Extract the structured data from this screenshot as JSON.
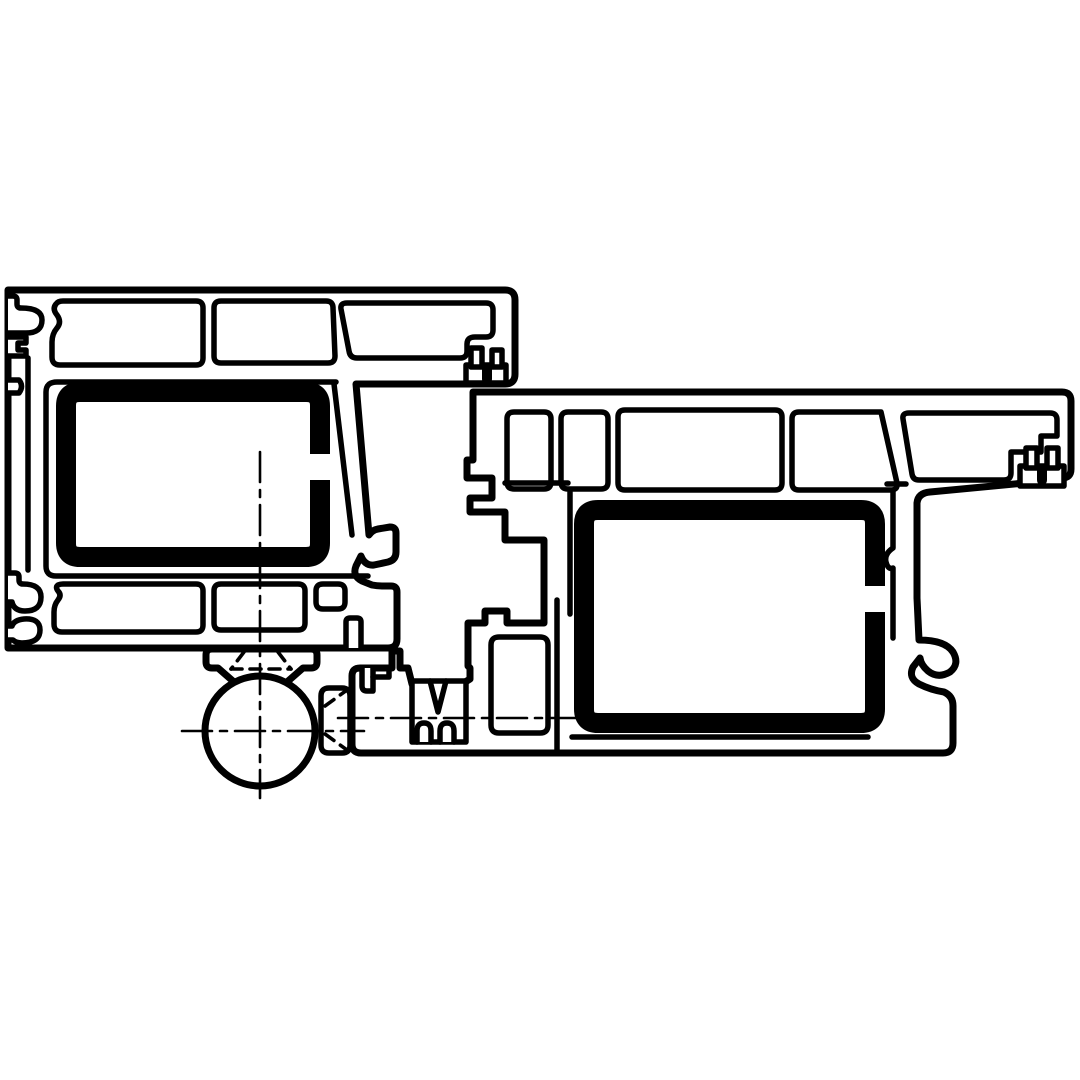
{
  "meta": {
    "description": "Technical cross-section drawing of two extruded door/window profiles (frame and leaf) with hollow chambers, steel reinforcement tubes, gasket grooves, a threshold connector and a barrel hinge",
    "canvas": {
      "width": 1080,
      "height": 1080,
      "background": "#ffffff"
    }
  },
  "palette": {
    "ink": "#000000",
    "paper": "#ffffff"
  },
  "line_weights": {
    "outer": 7,
    "inner": 5.5,
    "steel": 20,
    "centerline": 2.6,
    "hidden": 3.6
  },
  "dash_patterns": {
    "centerline": "30 8 7 8",
    "hidden": "11 8"
  },
  "drawing": {
    "shapes": [
      {
        "id": "frame-profile-body",
        "kind": "path",
        "d": "M 8 290 L 505 290 Q 515 290 515 300 L 515 374 Q 515 384 505 384 L 356 384 L 369 535 Q 372 530 378 529 L 390 527 Q 396 527 396 533 L 396 552 Q 396 560 388 562 L 374 565 Q 365 566 361 556 L 356 566 Q 352 576 362 581 L 372 585 Q 377 586 383 586 L 391 586 Q 397 586 397 592 L 397 639 Q 397 648 388 648 L 8 648 Z",
        "fill": "paper",
        "stroke": "ink",
        "w": "outer"
      },
      {
        "id": "frame-gasket-groove-top",
        "kind": "path",
        "d": "M 8 296 L 13 296 Q 17 296 17 300 L 17 304 Q 17 308 21 308 Q 42 308 42 320 Q 42 333 26 333 L 8 333",
        "fill": "paper",
        "stroke": "ink",
        "w": "inner"
      },
      {
        "id": "frame-gasket-groove-mid",
        "kind": "path",
        "d": "M 8 337 L 26 337 L 26 343 L 18 343 L 18 350 L 26 350 L 26 356 L 8 356",
        "fill": "paper",
        "stroke": "ink",
        "w": "inner"
      },
      {
        "id": "frame-gasket-groove-small",
        "kind": "path",
        "d": "M 8 380 L 19 380 Q 24 386 19 393 L 8 393",
        "fill": "paper",
        "stroke": "ink",
        "w": "inner"
      },
      {
        "id": "frame-gasket-pocket-lower-1",
        "kind": "path",
        "d": "M 8 573 L 15 573 Q 19 573 19 577 L 19 580 Q 19 584 23 584 Q 41 584 41 597 Q 41 611 25 611 Q 14 611 12 602 L 8 602",
        "fill": "paper",
        "stroke": "ink",
        "w": "inner"
      },
      {
        "id": "frame-gasket-pocket-lower-2",
        "kind": "path",
        "d": "M 8 640 L 13 640 Q 16 643 22 643 Q 40 643 40 630 Q 40 618 24 619 Q 14 620 12 626 L 8 626",
        "fill": "paper",
        "stroke": "ink",
        "w": "inner"
      },
      {
        "id": "frame-wall-vertical",
        "kind": "path",
        "d": "M 28 358 L 28 570",
        "fill": "none",
        "stroke": "ink",
        "w": "inner"
      },
      {
        "id": "frame-chamber-top-1",
        "kind": "path",
        "d": "M 63 301 L 196 301 Q 203 301 203 308 L 203 358 Q 203 365 196 365 L 60 365 Q 52 365 52 357 L 52 342 Q 52 334 57 328 Q 62 322 57 315 Q 52 309 56 304 Q 58 301 63 301 Z",
        "fill": "paper",
        "stroke": "ink",
        "w": "inner"
      },
      {
        "id": "frame-chamber-top-2",
        "kind": "path",
        "d": "M 221 301 L 326 301 Q 333 301 333 308 L 335 356 Q 335 363 328 363 L 221 363 Q 214 363 214 356 L 214 308 Q 214 301 221 301 Z",
        "fill": "paper",
        "stroke": "ink",
        "w": "inner"
      },
      {
        "id": "frame-chamber-top-3",
        "kind": "path",
        "d": "M 347 303 L 486 303 Q 493 303 493 310 L 493 330 Q 493 337 486 337 L 475 337 Q 467 337 467 344 L 467 351 Q 467 358 460 358 L 357 358 Q 350 358 349 351 L 341 309 Q 340 303 347 303 Z",
        "fill": "paper",
        "stroke": "ink",
        "w": "inner"
      },
      {
        "id": "frame-steel-chamber-wall",
        "kind": "path",
        "d": "M 336 382 L 57 382 Q 46 382 46 392 L 46 566 Q 46 576 56 576 L 368 576",
        "fill": "none",
        "stroke": "ink",
        "w": "inner"
      },
      {
        "id": "frame-inner-diagonal-wall",
        "kind": "path",
        "d": "M 334 384 L 352 535",
        "fill": "none",
        "stroke": "ink",
        "w": "inner"
      },
      {
        "id": "frame-chamber-bottom-1",
        "kind": "path",
        "d": "M 63 584 L 196 584 Q 203 584 203 591 L 203 625 Q 203 632 196 632 L 62 632 Q 54 632 54 624 L 54 612 Q 54 605 58 600 Q 62 595 58 591 Q 55 587 58 585 Q 60 584 63 584 Z",
        "fill": "paper",
        "stroke": "ink",
        "w": "inner"
      },
      {
        "id": "frame-chamber-bottom-2",
        "kind": "path",
        "d": "M 221 584 L 298 584 Q 305 584 305 591 L 305 623 Q 305 630 298 630 L 221 630 Q 214 630 214 623 L 214 591 Q 214 584 221 584 Z",
        "fill": "paper",
        "stroke": "ink",
        "w": "inner"
      },
      {
        "id": "frame-chamber-bottom-3",
        "kind": "path",
        "d": "M 323 584 L 338 584 Q 345 584 345 591 L 345 602 Q 345 609 338 609 L 323 609 Q 316 609 316 602 L 316 591 Q 316 584 323 584 Z",
        "fill": "paper",
        "stroke": "ink",
        "w": "inner"
      },
      {
        "id": "frame-bottom-slot",
        "kind": "path",
        "d": "M 346 648 L 346 622 Q 346 618 350 618 L 357 618 Q 361 618 361 622 L 361 648",
        "fill": "paper",
        "stroke": "ink",
        "w": "inner"
      },
      {
        "id": "frame-hardware-groove-bar",
        "kind": "path",
        "d": "M 466 365 L 506 365 L 506 383 L 466 383 Z",
        "fill": "paper",
        "stroke": "ink",
        "w": "inner"
      },
      {
        "id": "frame-hardware-groove-lobe-1",
        "kind": "path",
        "d": "M 471 348 L 482 348 L 482 367 L 471 367 Z",
        "fill": "paper",
        "stroke": "ink",
        "w": "inner"
      },
      {
        "id": "frame-hardware-groove-lobe-2",
        "kind": "path",
        "d": "M 492 350 L 502 350 L 502 367 L 492 367 Z",
        "fill": "paper",
        "stroke": "ink",
        "w": "inner"
      },
      {
        "id": "frame-hardware-groove-tongue",
        "kind": "path",
        "d": "M 482 365 L 492 365 L 492 379 Q 492 384 487 384 Q 482 384 482 379 Z",
        "fill": "ink",
        "stroke": "none",
        "w": "inner"
      },
      {
        "id": "leaf-profile-body",
        "kind": "path",
        "d": "M 473 392 L 1062 392 Q 1071 392 1071 401 L 1071 469 Q 1071 478 1062 478 L 1056 480 L 930 492 Q 918 493 917 503 L 917 598 L 919 640 Q 945 640 953 652 Q 960 664 950 672 Q 938 679 928 671 Q 921 665 920 658 L 913 667 Q 908 678 919 684 Q 931 690 944 692 Q 953 696 953 706 L 953 743 Q 953 753 943 753 L 361 753 Q 352 753 352 744 L 352 676 Q 352 668 360 668 L 392 668 L 392 651 L 400 651 L 400 668 L 408 668 L 412 684 L 462 684 L 470 679 L 470 668 L 468 666 L 468 623 L 485 623 L 485 611 L 507 611 L 507 623 L 544 623 L 544 540 L 505 540 L 505 512 L 470 512 L 470 498 L 492 498 L 492 478 L 467 478 L 467 460 L 473 460 Z",
        "fill": "paper",
        "stroke": "ink",
        "w": "outer"
      },
      {
        "id": "leaf-chamber-1",
        "kind": "path",
        "d": "M 514 412 L 544 412 Q 551 412 551 419 L 551 482 Q 551 489 544 489 L 514 489 Q 507 489 507 482 L 507 419 Q 507 412 514 412 Z",
        "fill": "paper",
        "stroke": "ink",
        "w": "inner"
      },
      {
        "id": "leaf-chamber-2",
        "kind": "path",
        "d": "M 568 412 L 601 412 Q 608 412 608 419 L 608 482 Q 608 489 601 489 L 568 489 Q 561 489 561 482 L 561 419 Q 561 412 568 412 Z",
        "fill": "paper",
        "stroke": "ink",
        "w": "inner"
      },
      {
        "id": "leaf-chamber-3",
        "kind": "path",
        "d": "M 625 410 L 775 410 Q 782 410 782 417 L 782 483 Q 782 490 775 490 L 625 490 Q 618 490 618 483 L 618 417 Q 618 410 625 410 Z",
        "fill": "paper",
        "stroke": "ink",
        "w": "inner"
      },
      {
        "id": "leaf-chamber-4",
        "kind": "path",
        "d": "M 799 412 L 881 412 L 897 483 Q 898 490 891 490 L 799 490 Q 792 490 792 483 L 792 419 Q 792 412 799 412 Z",
        "fill": "paper",
        "stroke": "ink",
        "w": "inner"
      },
      {
        "id": "leaf-chamber-5",
        "kind": "path",
        "d": "M 912 474 L 903 419 Q 902 413 909 413 L 1050 413 Q 1057 413 1057 420 L 1057 436 L 1041 436 L 1041 452 L 1011 452 L 1011 473 Q 1011 480 1004 480 L 919 480 Q 913 480 912 474 Z",
        "fill": "paper",
        "stroke": "ink",
        "w": "inner"
      },
      {
        "id": "leaf-steel-chamber-wall-left",
        "kind": "path",
        "d": "M 570 492 L 570 614",
        "fill": "none",
        "stroke": "ink",
        "w": "inner"
      },
      {
        "id": "leaf-steel-chamber-wall-right",
        "kind": "path",
        "d": "M 893 490 L 893 548 Q 884 554 886 562 Q 888 570 893 568 L 893 638",
        "fill": "none",
        "stroke": "ink",
        "w": "inner"
      },
      {
        "id": "leaf-underchamber-line-left",
        "kind": "path",
        "d": "M 505 483 L 568 483",
        "fill": "none",
        "stroke": "ink",
        "w": "inner"
      },
      {
        "id": "leaf-underchamber-line-right",
        "kind": "path",
        "d": "M 887 484 L 906 484",
        "fill": "none",
        "stroke": "ink",
        "w": "inner"
      },
      {
        "id": "leaf-bottom-inner-line",
        "kind": "path",
        "d": "M 572 737 L 868 737",
        "fill": "none",
        "stroke": "ink",
        "w": "inner"
      },
      {
        "id": "leaf-foot-wall",
        "kind": "path",
        "d": "M 557 600 L 557 750",
        "fill": "none",
        "stroke": "ink",
        "w": "inner"
      },
      {
        "id": "leaf-foot-chamber",
        "kind": "path",
        "d": "M 499 637 L 540 637 Q 548 637 548 645 L 548 725 Q 548 733 540 733 L 499 733 Q 491 733 491 725 L 491 645 Q 491 637 499 637 Z",
        "fill": "paper",
        "stroke": "ink",
        "w": "inner"
      },
      {
        "id": "leaf-hardware-groove-bar",
        "kind": "path",
        "d": "M 1020 466 L 1064 466 L 1064 486 L 1020 486 Z",
        "fill": "paper",
        "stroke": "ink",
        "w": "inner"
      },
      {
        "id": "leaf-hardware-groove-lobe-1",
        "kind": "path",
        "d": "M 1026 448 L 1037 448 L 1037 468 L 1026 468 Z",
        "fill": "paper",
        "stroke": "ink",
        "w": "inner"
      },
      {
        "id": "leaf-hardware-groove-lobe-2",
        "kind": "path",
        "d": "M 1047 448 L 1058 448 L 1058 468 L 1047 468 Z",
        "fill": "paper",
        "stroke": "ink",
        "w": "inner"
      },
      {
        "id": "leaf-hardware-groove-tongue",
        "kind": "path",
        "d": "M 1037 466 L 1047 466 L 1047 480 Q 1047 485 1042 485 Q 1037 485 1037 480 Z",
        "fill": "ink",
        "stroke": "none",
        "w": "inner"
      },
      {
        "id": "threshold-clip-slot",
        "kind": "path",
        "d": "M 362 668 L 362 686 Q 362 691 367 691 L 373 691 L 373 668",
        "fill": "paper",
        "stroke": "ink",
        "w": "inner"
      },
      {
        "id": "threshold-clip-tab",
        "kind": "path",
        "d": "M 373 677 L 389 677 L 389 668",
        "fill": "none",
        "stroke": "ink",
        "w": "inner"
      },
      {
        "id": "threshold-clip-box",
        "kind": "path",
        "d": "M 412 681 L 466 681 L 466 742 L 412 742 Z",
        "fill": "paper",
        "stroke": "ink",
        "w": "inner"
      },
      {
        "id": "threshold-clip-vgroove",
        "kind": "path",
        "d": "M 430 681 L 438 712 L 446 681",
        "fill": "none",
        "stroke": "ink",
        "w": "inner"
      },
      {
        "id": "threshold-clip-unotch-1",
        "kind": "path",
        "d": "M 417 742 L 417 731 Q 417 723 424 723 Q 431 723 431 731 L 431 742",
        "fill": "paper",
        "stroke": "ink",
        "w": "inner"
      },
      {
        "id": "threshold-clip-unotch-2",
        "kind": "path",
        "d": "M 440 742 L 440 731 Q 440 723 447 723 Q 454 723 454 731 L 454 742",
        "fill": "paper",
        "stroke": "ink",
        "w": "inner"
      },
      {
        "id": "hinge-mounting-plate",
        "kind": "path",
        "d": "M 212 649 L 311 649 Q 317 649 317 655 L 317 662 Q 317 668 311 668 L 303 668 L 287 682 L 234 682 L 218 668 L 212 668 Q 206 668 206 662 L 206 655 Q 206 649 212 649 Z",
        "fill": "paper",
        "stroke": "ink",
        "w": "outer"
      },
      {
        "id": "hinge-spacer-block",
        "kind": "path",
        "d": "M 329 688 L 342 688 Q 350 688 350 696 L 350 745 Q 350 753 342 753 L 329 753 Q 321 753 321 745 L 321 696 Q 321 688 329 688 Z",
        "fill": "paper",
        "stroke": "ink",
        "w": "inner"
      },
      {
        "id": "hinge-barrel-circle",
        "kind": "circle",
        "cx": 260,
        "cy": 731,
        "r": 55,
        "fill": "paper",
        "stroke": "ink",
        "w": "outer"
      },
      {
        "id": "frame-steel-reinforcement",
        "kind": "path",
        "d": "M 80 392 L 306 392 Q 320 392 320 406 L 320 543 Q 320 557 306 557 L 80 557 Q 66 557 66 543 L 66 406 Q 66 392 80 392 Z",
        "fill": "none",
        "stroke": "ink",
        "w": "steel"
      },
      {
        "id": "frame-steel-seam-gap",
        "kind": "path",
        "d": "M 306 454 L 332 454 L 332 480 L 306 480 Z",
        "fill": "paper",
        "stroke": "none",
        "w": "inner"
      },
      {
        "id": "leaf-steel-reinforcement",
        "kind": "path",
        "d": "M 598 510 L 861 510 Q 875 510 875 524 L 875 709 Q 875 723 861 723 L 598 723 Q 584 723 584 709 L 584 524 Q 584 510 598 510 Z",
        "fill": "none",
        "stroke": "ink",
        "w": "steel"
      },
      {
        "id": "leaf-steel-seam-gap",
        "kind": "path",
        "d": "M 864 586 L 888 586 L 888 612 L 864 612 Z",
        "fill": "paper",
        "stroke": "none",
        "w": "inner"
      },
      {
        "id": "hinge-hidden-screw-left",
        "kind": "path",
        "d": "M 244 652 L 231 669",
        "fill": "none",
        "stroke": "ink",
        "w": "hidden",
        "dash": "hidden"
      },
      {
        "id": "hinge-hidden-screw-right",
        "kind": "path",
        "d": "M 278 652 L 291 669",
        "fill": "none",
        "stroke": "ink",
        "w": "hidden",
        "dash": "hidden"
      },
      {
        "id": "hinge-hidden-screw-base",
        "kind": "path",
        "d": "M 231 669 L 291 669",
        "fill": "none",
        "stroke": "ink",
        "w": "hidden",
        "dash": "hidden"
      },
      {
        "id": "hinge-hidden-block-1",
        "kind": "path",
        "d": "M 325 706 L 347 690",
        "fill": "none",
        "stroke": "ink",
        "w": "hidden",
        "dash": "hidden"
      },
      {
        "id": "hinge-hidden-block-2",
        "kind": "path",
        "d": "M 325 734 L 347 750",
        "fill": "none",
        "stroke": "ink",
        "w": "hidden",
        "dash": "hidden"
      },
      {
        "id": "centerline-vertical-hinge-axis",
        "kind": "path",
        "d": "M 260 452 L 260 798",
        "fill": "none",
        "stroke": "ink",
        "w": "centerline",
        "dash": "centerline"
      },
      {
        "id": "centerline-horizontal-hinge-axis",
        "kind": "path",
        "d": "M 182 731 L 364 731",
        "fill": "none",
        "stroke": "ink",
        "w": "centerline",
        "dash": "centerline"
      },
      {
        "id": "centerline-horizontal-threshold-axis",
        "kind": "path",
        "d": "M 338 718 L 590 718",
        "fill": "none",
        "stroke": "ink",
        "w": "centerline",
        "dash": "centerline"
      }
    ]
  }
}
